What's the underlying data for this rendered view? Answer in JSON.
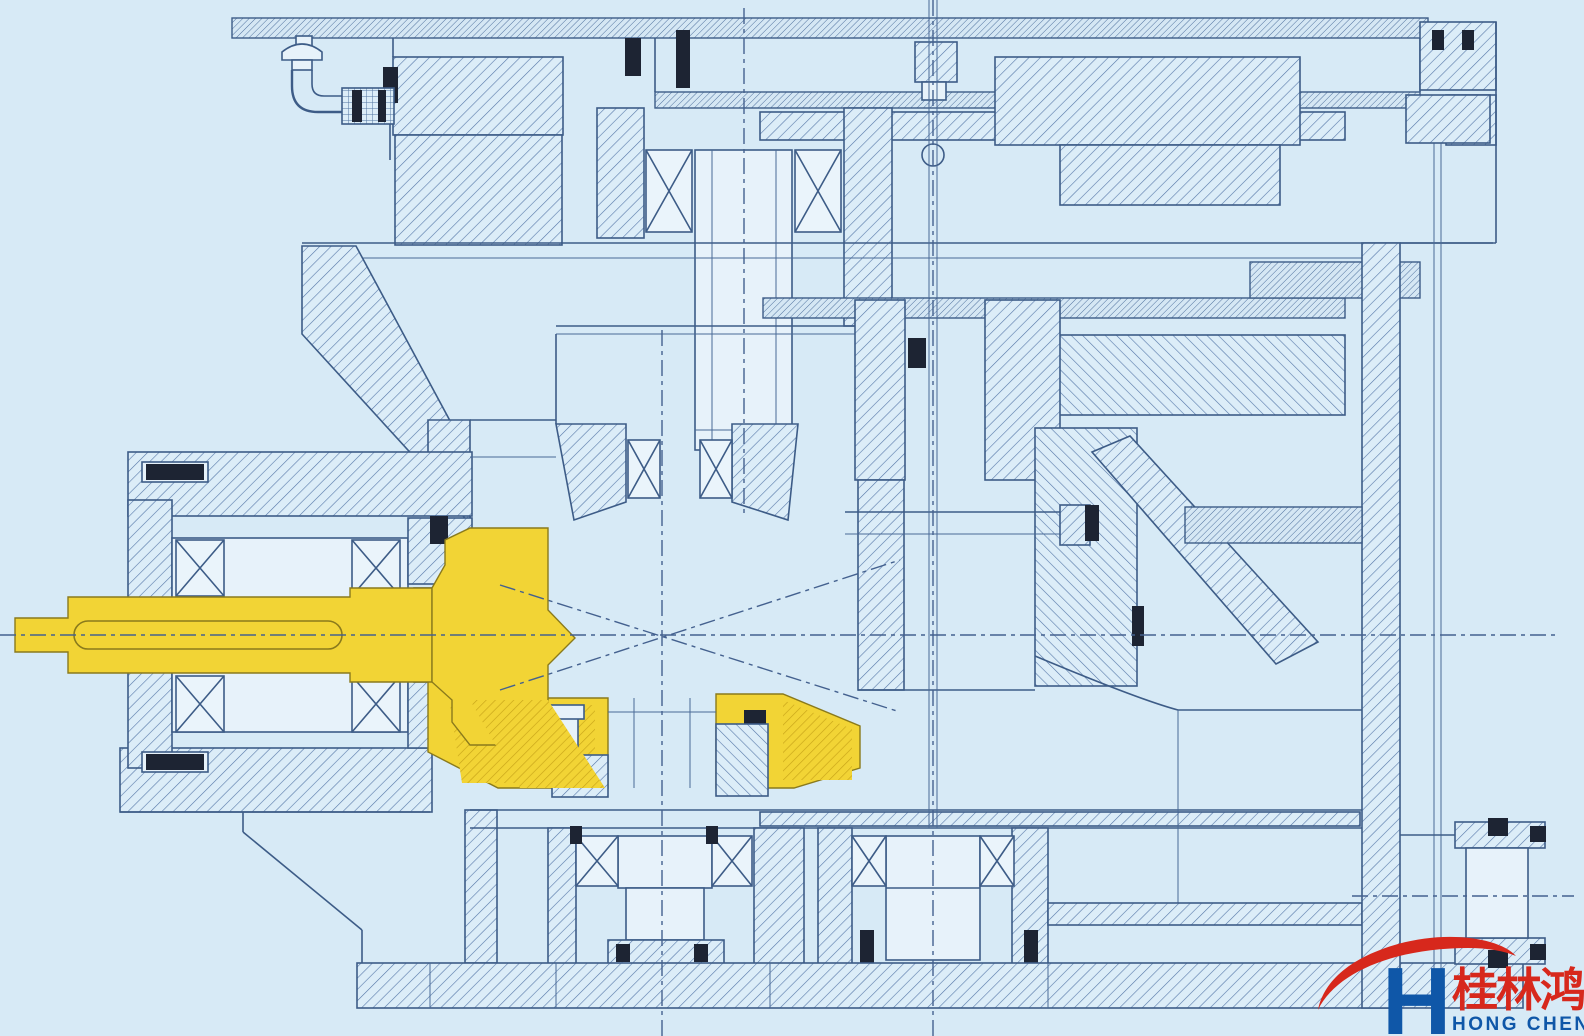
{
  "colors": {
    "background": "#d7eaf6",
    "line": "#3d5c87",
    "hatch": "#5678a8",
    "highlight": "#f2d435",
    "highlight_hatch": "#c8a418",
    "black_detail": "#1d2433",
    "logo_red": "#d7281c",
    "logo_blue": "#0f57a8"
  },
  "logo": {
    "brand_chinese": "桂林鸿程",
    "brand_english": "HONG CHENG"
  },
  "diagram": {
    "type": "engineering-cross-section",
    "subject": "gear reducer sectional drawing",
    "highlighted_parts": [
      "bevel-pinion-input-shaft",
      "bevel-ring-gear"
    ]
  }
}
